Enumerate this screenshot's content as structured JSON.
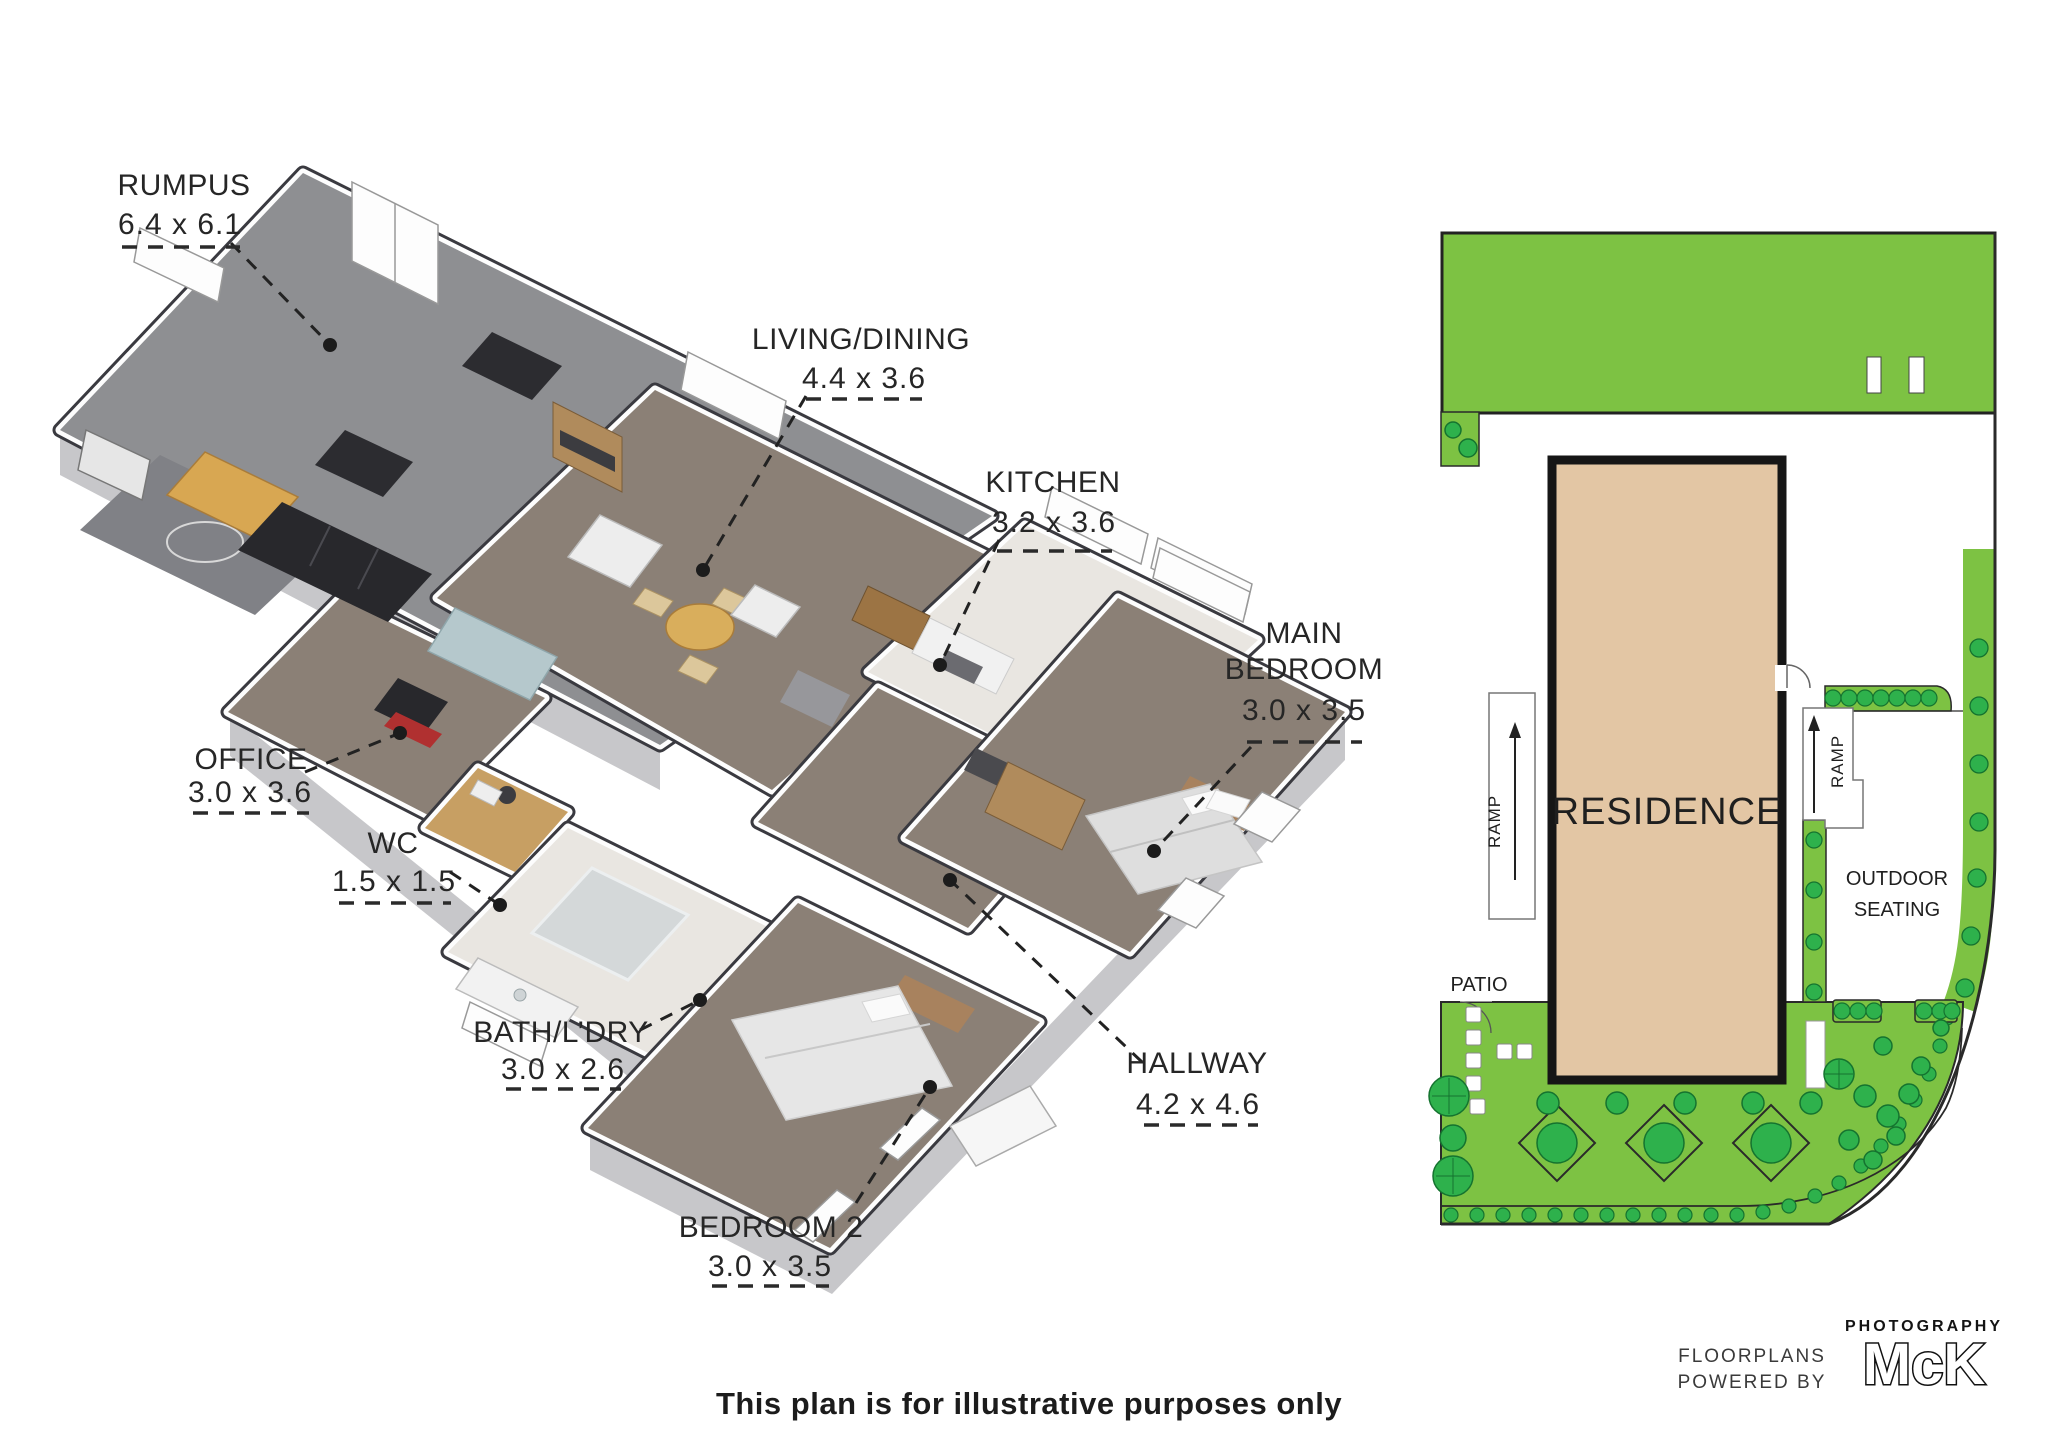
{
  "floor_plan": {
    "rooms": [
      {
        "id": "rumpus",
        "name": "RUMPUS",
        "dims": "6.4 x 6.1"
      },
      {
        "id": "living-dining",
        "name": "LIVING/DINING",
        "dims": "4.4 x 3.6"
      },
      {
        "id": "kitchen",
        "name": "KITCHEN",
        "dims": "3.2 x 3.6"
      },
      {
        "id": "main-bedroom",
        "name": "MAIN BEDROOM",
        "dims": "3.0 x 3.5"
      },
      {
        "id": "office",
        "name": "OFFICE",
        "dims": "3.0 x 3.6"
      },
      {
        "id": "wc",
        "name": "WC",
        "dims": "1.5 x 1.5"
      },
      {
        "id": "bath-ldry",
        "name": "BATH/L’DRY",
        "dims": "3.0 x 2.6"
      },
      {
        "id": "hallway",
        "name": "HALLWAY",
        "dims": "4.2 x 4.6"
      },
      {
        "id": "bedroom-2",
        "name": "BEDROOM 2",
        "dims": "3.0 x 3.5"
      }
    ]
  },
  "site_plan": {
    "residence_label": "RESIDENCE",
    "ramp_left_label": "RAMP",
    "ramp_right_label": "RAMP",
    "patio_label": "PATIO",
    "outdoor_seating_line1": "OUTDOOR",
    "outdoor_seating_line2": "SEATING"
  },
  "footer": {
    "disclaimer": "This plan is for illustrative purposes only"
  },
  "credit": {
    "line1": "FLOORPLANS",
    "line2": "POWERED BY",
    "brand": "McK",
    "brand_sub": "PHOTOGRAPHY"
  },
  "colors": {
    "lawn_green": "#7dc243",
    "tree_green": "#2eb14c",
    "tree_outline": "#15732f",
    "residence_fill": "#e3c6a4",
    "outline_black": "#1a1a1a",
    "wall_cap": "#3a3a40",
    "carpet": "#8b8076",
    "tile": "#e9e6e1",
    "rumpus_floor": "#8e8f92",
    "wood_floor": "#c79f63"
  }
}
